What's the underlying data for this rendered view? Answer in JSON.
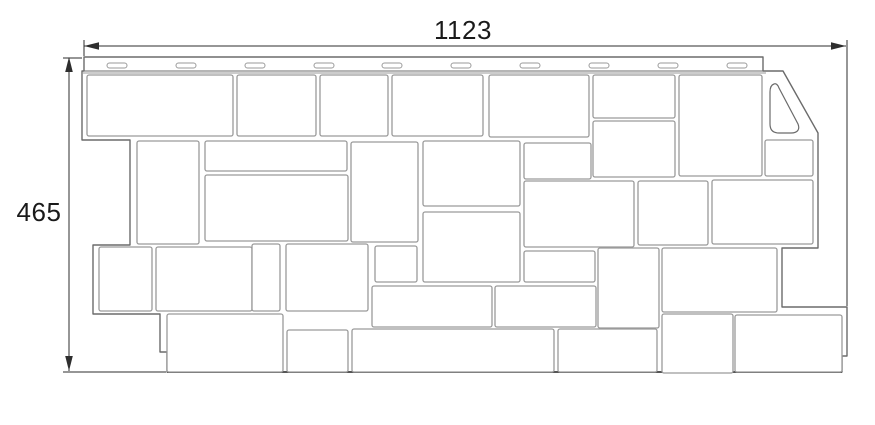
{
  "title": "Facade panel dimension drawing",
  "dimensions": {
    "width_label": "1123",
    "height_label": "465"
  },
  "colors": {
    "outline": "#6b6b6b",
    "stone": "#9a9a9a",
    "bottom_edge": "#555555",
    "dimension": "#2e2e2e",
    "text": "#1a1a1a",
    "background": "#ffffff"
  },
  "diagram": {
    "canvas": {
      "w": 875,
      "h": 425
    },
    "outline_points": "84,57 763,57 763,71 783,71 818,133 818,248 782,248 782,307 847,307 847,356 842,356 842,372 167,372 167,352 160,352 160,314 93,314 93,245 130,245 130,140 82,140 82,71 84,71",
    "strip": {
      "x1": 84,
      "x2": 763,
      "top": 57,
      "bottom": 71,
      "field_top": 73,
      "field_x1": 82,
      "field_x2": 766
    },
    "bottom_edge": {
      "x1": 167,
      "x2": 842,
      "y": 372
    },
    "slots": {
      "y": 63,
      "w": 20,
      "h": 5,
      "xs": [
        107,
        176,
        245,
        314,
        382,
        451,
        520,
        589,
        658,
        727
      ]
    },
    "hole_path": "M774,84 C771,85 770,88 770,92 L770,124 C770,130 773,133 779,133 L791,133 C798,133 800,129 798,124 L779,88 C778,85 776,83 774,84 Z",
    "stones": [
      [
        87,
        75,
        146,
        61
      ],
      [
        237,
        75,
        79,
        61
      ],
      [
        320,
        75,
        68,
        61
      ],
      [
        392,
        75,
        91,
        61
      ],
      [
        489,
        75,
        100,
        62
      ],
      [
        593,
        75,
        82,
        43
      ],
      [
        679,
        75,
        83,
        101
      ],
      [
        765,
        140,
        48,
        36
      ],
      [
        137,
        141,
        62,
        103
      ],
      [
        205,
        141,
        142,
        30
      ],
      [
        205,
        175,
        143,
        66
      ],
      [
        351,
        142,
        67,
        100
      ],
      [
        423,
        141,
        97,
        65
      ],
      [
        524,
        143,
        67,
        36
      ],
      [
        593,
        121,
        82,
        56
      ],
      [
        524,
        181,
        110,
        66
      ],
      [
        638,
        181,
        70,
        64
      ],
      [
        712,
        180,
        101,
        64
      ],
      [
        99,
        247,
        53,
        64
      ],
      [
        156,
        247,
        96,
        64
      ],
      [
        252,
        244,
        28,
        67
      ],
      [
        286,
        244,
        82,
        67
      ],
      [
        375,
        246,
        42,
        36
      ],
      [
        423,
        212,
        97,
        70
      ],
      [
        524,
        251,
        71,
        31
      ],
      [
        598,
        248,
        61,
        80
      ],
      [
        662,
        248,
        115,
        64
      ],
      [
        372,
        286,
        120,
        41
      ],
      [
        495,
        286,
        101,
        41
      ],
      [
        167,
        314,
        116,
        58
      ],
      [
        287,
        330,
        61,
        42
      ],
      [
        352,
        329,
        202,
        43
      ],
      [
        558,
        329,
        99,
        43
      ],
      [
        662,
        314,
        71,
        59
      ],
      [
        735,
        315,
        107,
        57
      ]
    ]
  }
}
